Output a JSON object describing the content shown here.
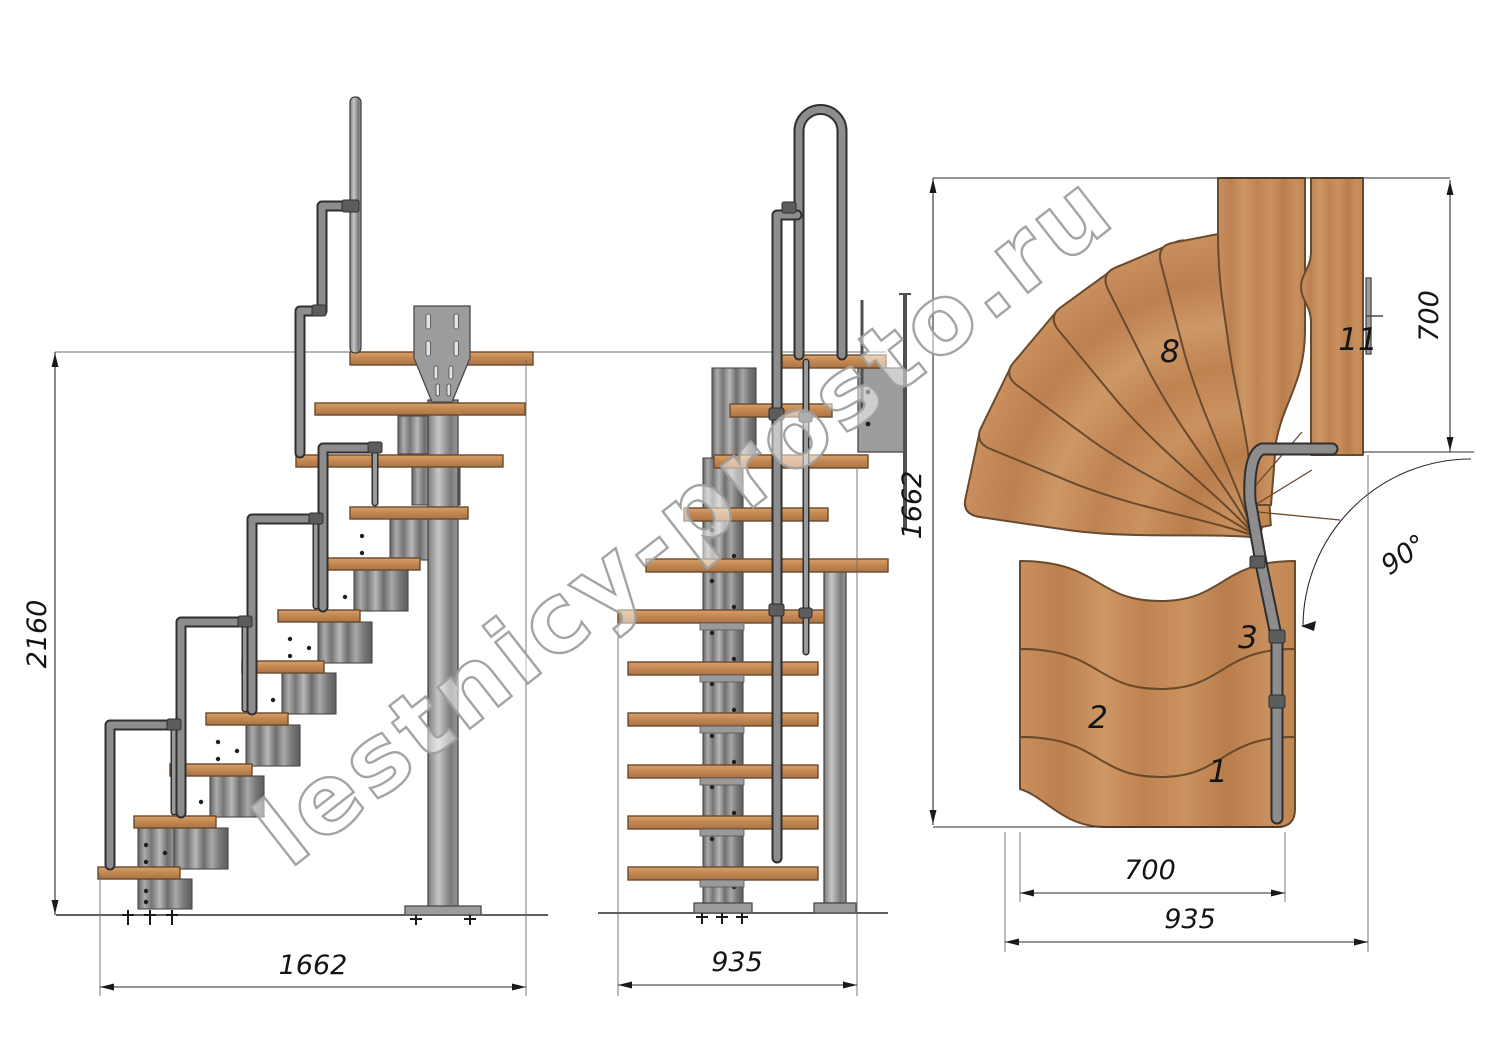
{
  "watermark": "lestnicy-prosto.ru",
  "dimensions": {
    "side_total_rise": "2160",
    "side_total_run": "1662",
    "front_total_width": "935",
    "plan_total_depth": "1662",
    "plan_landing_depth": "700",
    "plan_straight_tread_length": "700",
    "plan_total_width": "935",
    "plan_turn_angle": "90°"
  },
  "tread_labels": {
    "t1": "1",
    "t2": "2",
    "t3": "3",
    "t8": "8",
    "t11": "11"
  },
  "colors": {
    "wood": "#c2864f",
    "wood_edge": "#6a4a2c",
    "steel_light": "#b5b5b5",
    "steel": "#8d8d8d",
    "steel_dark": "#3e3e3e",
    "drawing_line": "#2b2b2b",
    "watermark_outline": "#9f9f9f",
    "background": "#ffffff"
  }
}
